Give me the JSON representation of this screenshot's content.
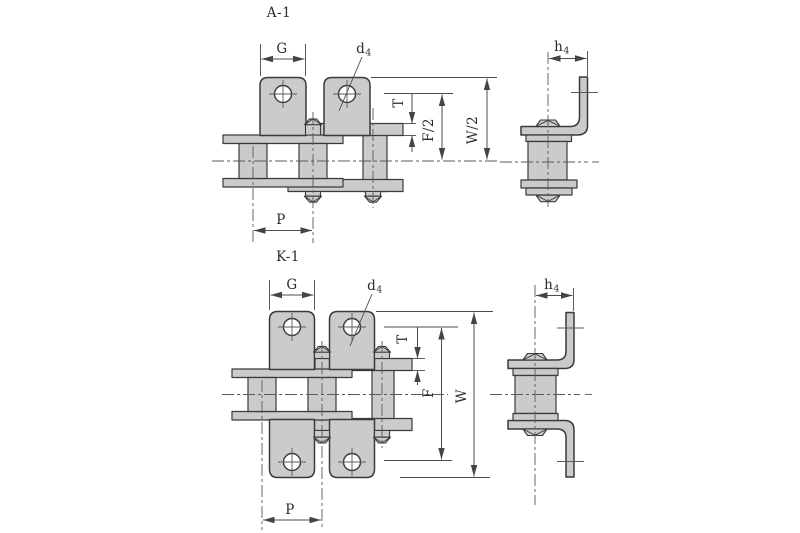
{
  "colors": {
    "fill": "#cacbca",
    "edge": "#3a3a3a",
    "dim": "#4b4b4b",
    "center": "#5a5a5a",
    "bg": "#ffffff",
    "text": "#2b2b2b"
  },
  "drawing_a1": {
    "label": "A-1",
    "dim_g": "G",
    "dim_d": "d",
    "dim_d_sub": "4",
    "dim_h": "h",
    "dim_h_sub": "4",
    "dim_t": "T",
    "dim_f": "F/2",
    "dim_w": "W/2",
    "dim_p": "P"
  },
  "drawing_k1": {
    "label": "K-1",
    "dim_g": "G",
    "dim_d": "d",
    "dim_d_sub": "4",
    "dim_h": "h",
    "dim_h_sub": "4",
    "dim_t": "T",
    "dim_f": "F",
    "dim_w": "W",
    "dim_p": "P"
  }
}
